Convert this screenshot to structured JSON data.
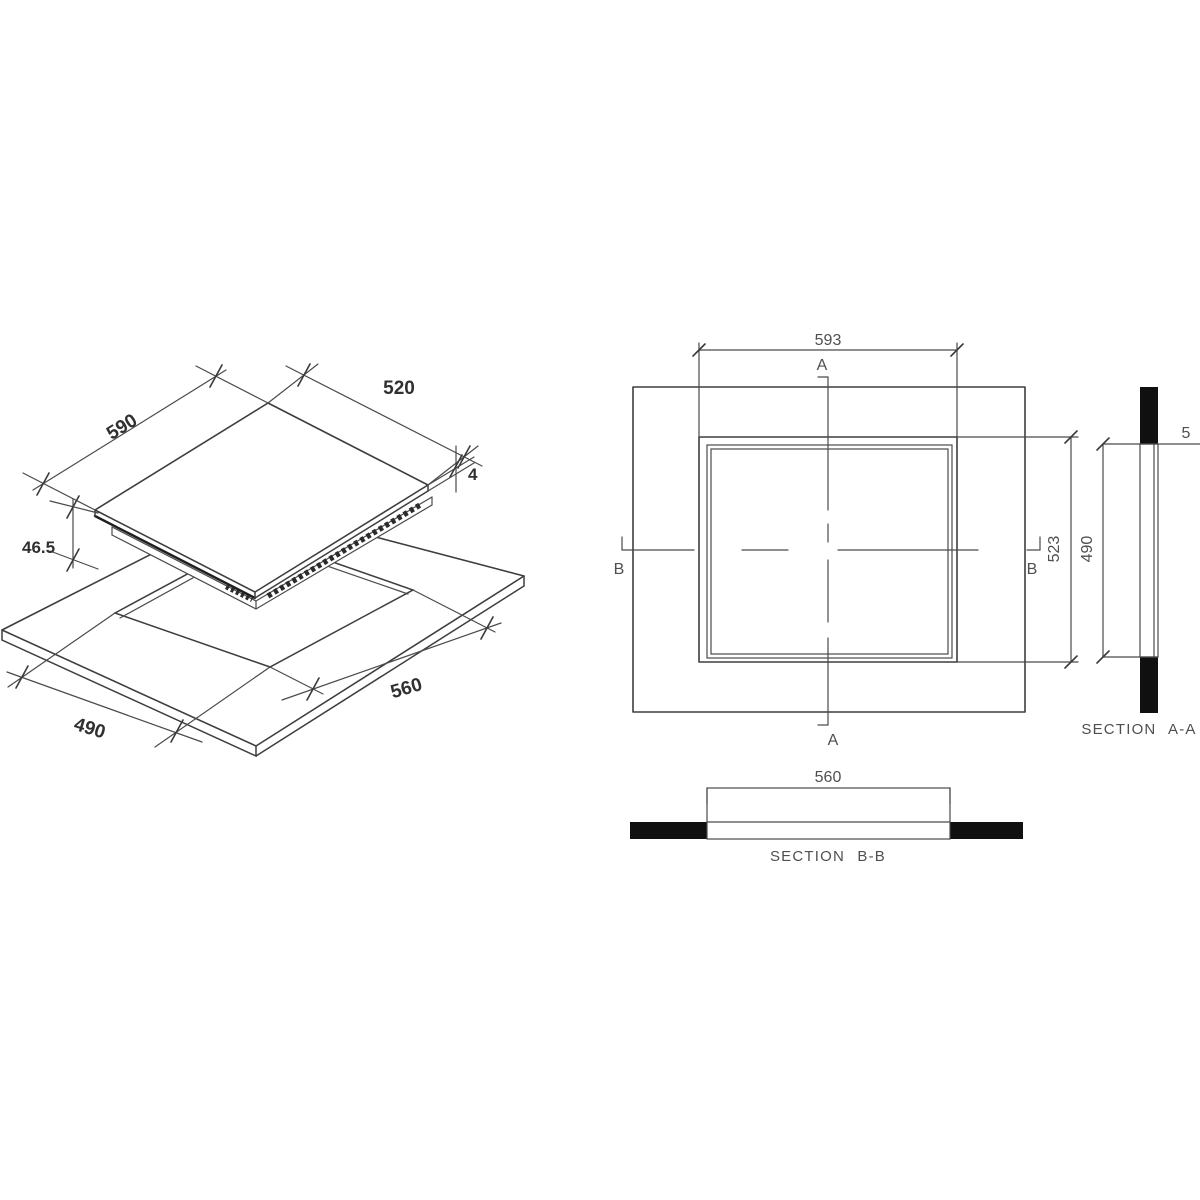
{
  "drawing": {
    "iso": {
      "hob_width": "590",
      "hob_depth": "520",
      "glass_thickness": "4",
      "height_below_top": "46.5",
      "cutout_width": "560",
      "cutout_depth": "490"
    },
    "plan": {
      "hob_width": "593",
      "hob_depth": "523",
      "marker_a": "A",
      "marker_b": "B"
    },
    "section_aa": {
      "title": "SECTION A-A",
      "cutout_depth": "490",
      "edge_dim": "5"
    },
    "section_bb": {
      "title": "SECTION B-B",
      "cutout_width": "560"
    }
  },
  "colors": {
    "line": "#3e3e3e",
    "dark_line": "#1f1f1f",
    "solid_fill": "#101010",
    "text_bold": "#303030",
    "text_regular": "#4f4f4f",
    "background": "#ffffff"
  }
}
